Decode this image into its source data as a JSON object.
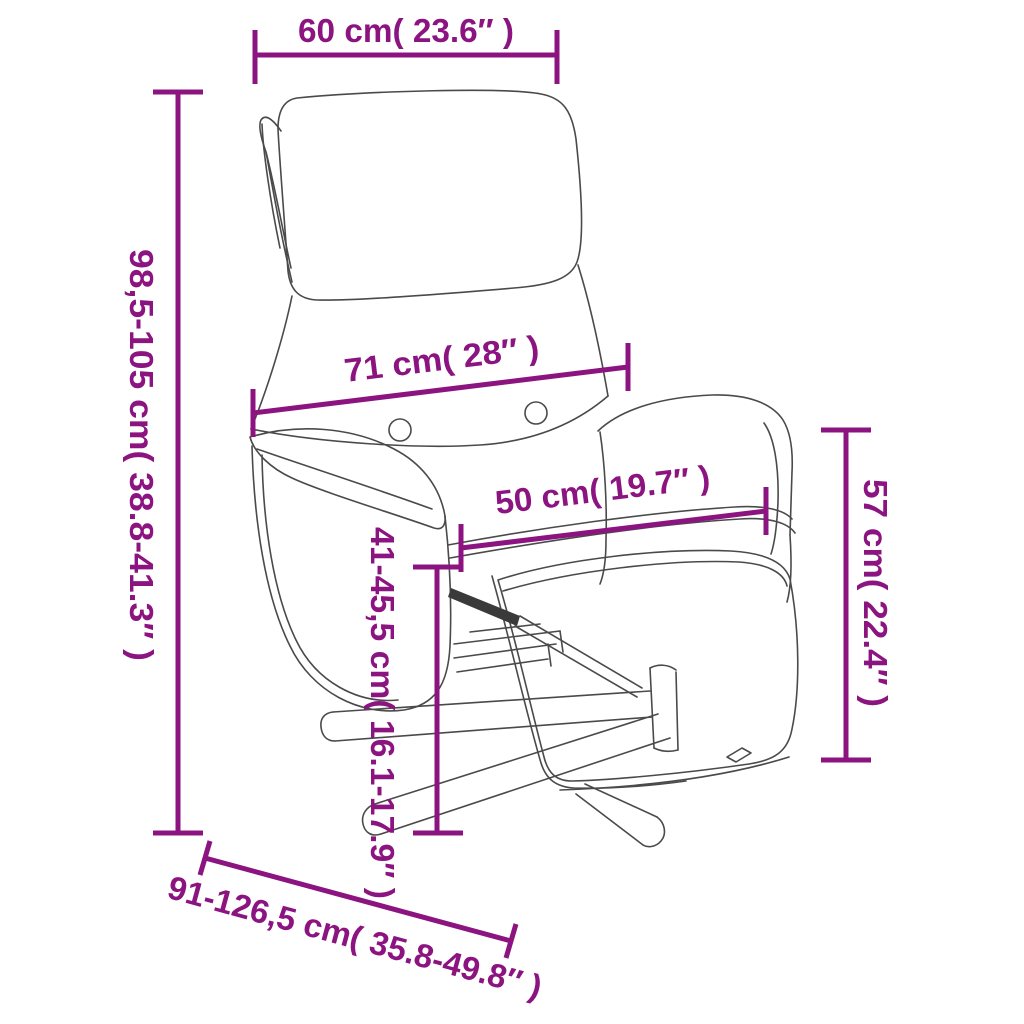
{
  "diagram": {
    "type": "product-dimension-diagram",
    "subject": "recliner chair with footrest",
    "background_color": "#ffffff",
    "accent_color": "#8C1480",
    "line_art_color": "#4a4a4a",
    "dimensions": {
      "headrest_width": "60 cm( 23.6″ )",
      "total_height": "98,5-105 cm( 38.8-41.3″ )",
      "back_width": "71 cm( 28″ )",
      "seat_width": "50 cm( 19.7″ )",
      "seat_height": "41-45,5 cm( 16.1-17.9″ )",
      "armrest_height": "57 cm( 22.4″ )",
      "total_depth": "91-126,5 cm( 35.8-49.8″ )"
    }
  }
}
